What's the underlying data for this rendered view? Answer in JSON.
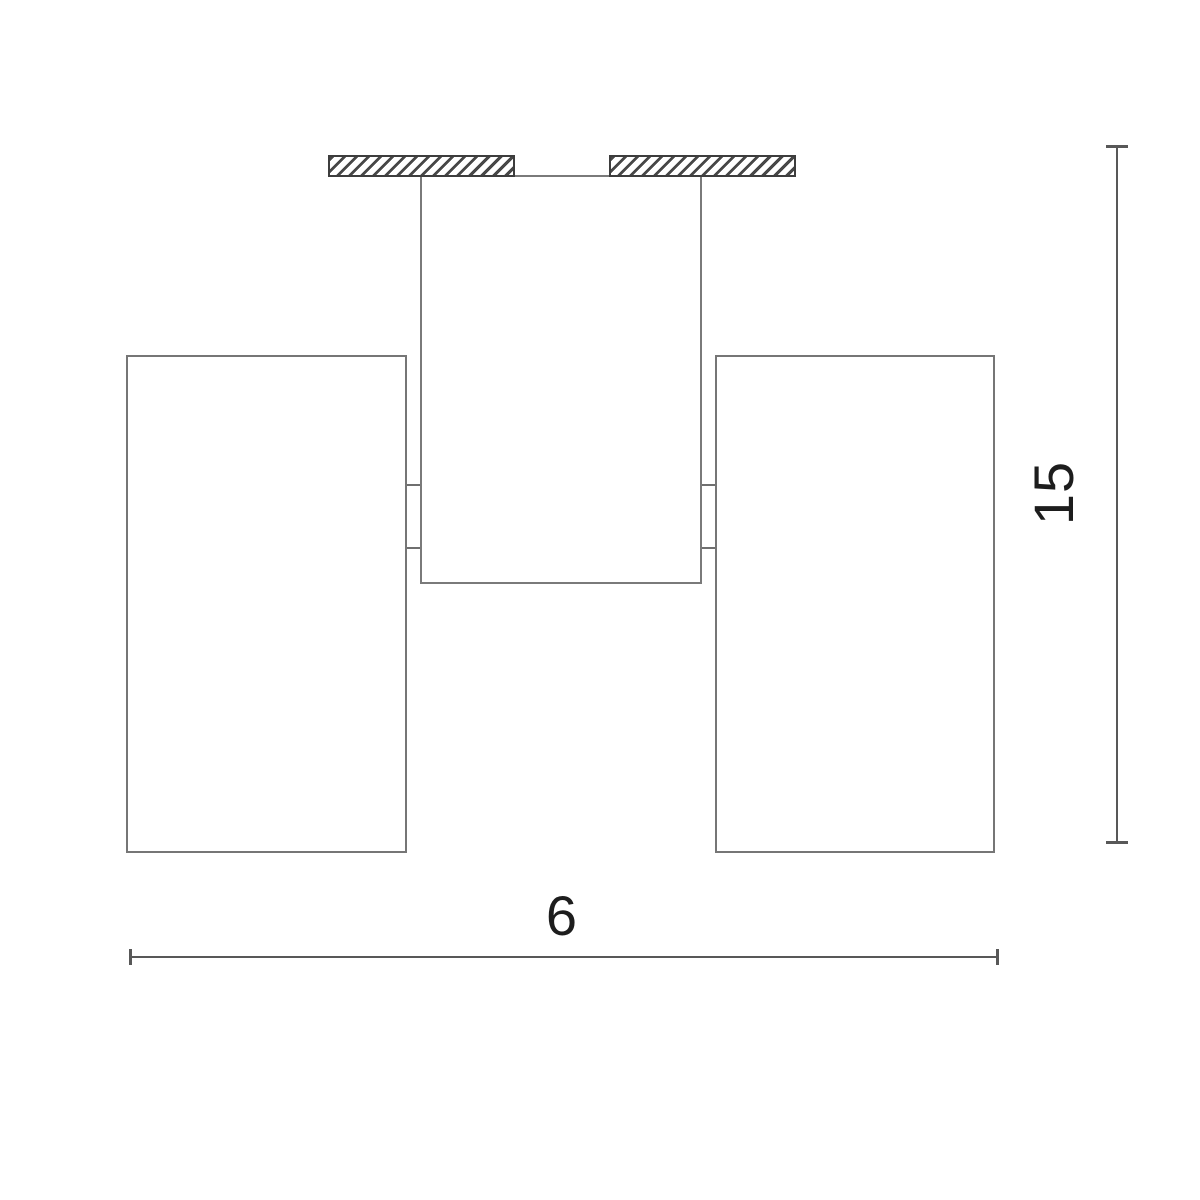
{
  "dimensions": {
    "width_label": "6",
    "height_label": "15"
  },
  "colors": {
    "background": "#ffffff",
    "outline_gray": "#7a7a7a",
    "hatch_line": "#474747",
    "hatch_border": "#3d3d3d",
    "dimension_line": "#585858",
    "label_text": "#1d1d1d"
  }
}
